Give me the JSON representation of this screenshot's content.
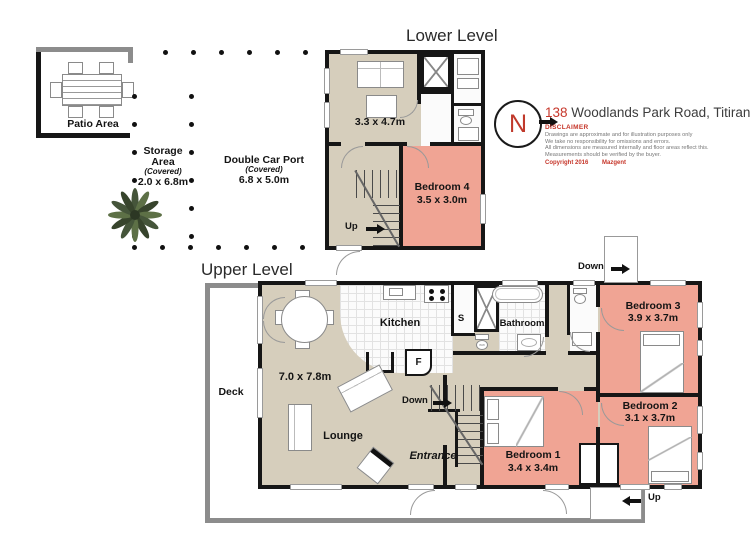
{
  "address": {
    "number": "138",
    "street": "Woodlands Park Road, Titirangi",
    "disclaimer_title": "DISCLAIMER",
    "disclaimer_lines": [
      "Drawings are approximate and for illustration purposes only",
      "We take no responsibility for omissions and errors.",
      "All dimensions are measured internally and floor areas reflect this.",
      "Measurements should be verified by the buyer."
    ],
    "copyright": "Copyright 2016",
    "brand": "Mazgent"
  },
  "compass": {
    "north": "N"
  },
  "outdoor": {
    "patio_label": "Patio Area",
    "storage_line1": "Storage",
    "storage_line2": "Area",
    "storage_line3": "(Covered)",
    "storage_line4": "2.0 x 6.8m",
    "carport_line1": "Double Car Port",
    "carport_line2": "(Covered)",
    "carport_line3": "6.8 x 5.0m"
  },
  "lower_level": {
    "title": "Lower Level",
    "living_dim": "3.3 x 4.7m",
    "bedroom4_name": "Bedroom 4",
    "bedroom4_dim": "3.5 x 3.0m",
    "up_label": "Up"
  },
  "upper_level": {
    "title": "Upper Level",
    "deck_label": "Deck",
    "lounge_dim": "7.0 x 7.8m",
    "lounge_label": "Lounge",
    "kitchen_label": "Kitchen",
    "shower_label": "S",
    "fridge_label": "F",
    "wc_label": "ww",
    "bathroom_label": "Bathroom",
    "entrance_label": "Entrance",
    "down_inner_label": "Down",
    "down_outer_label": "Down",
    "up_outer_label": "Up",
    "bedroom1_name": "Bedroom 1",
    "bedroom1_dim": "3.4 x 3.4m",
    "bedroom2_name": "Bedroom 2",
    "bedroom2_dim": "3.1 x 3.7m",
    "bedroom3_name": "Bedroom 3",
    "bedroom3_dim": "3.9 x 3.7m"
  },
  "colors": {
    "floor_beige": "#d6cebc",
    "room_pink": "#f0a494",
    "wall_black": "#161616",
    "deck_gray": "#8c8c8c",
    "accent_red": "#c6362a"
  }
}
